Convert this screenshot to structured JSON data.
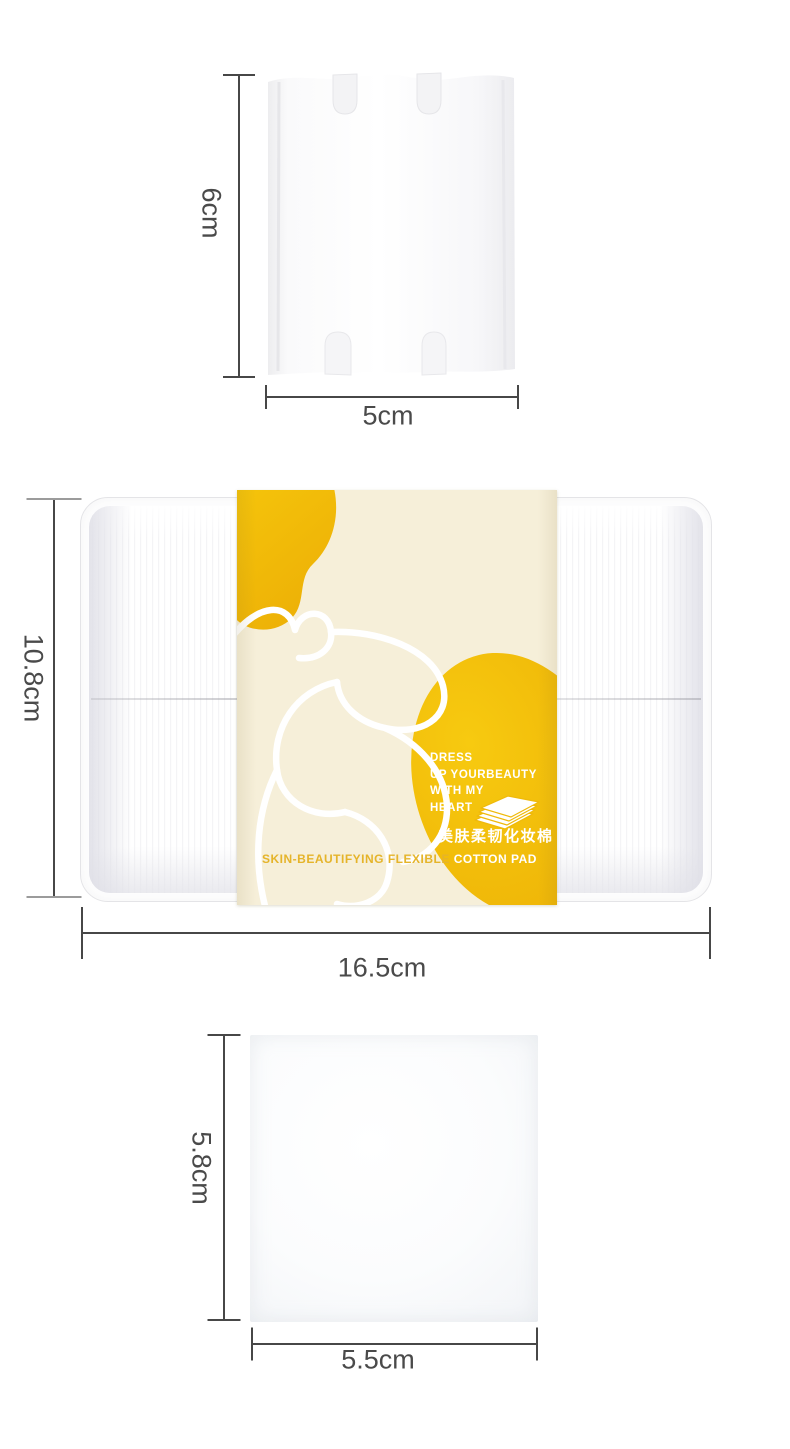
{
  "product_dimensions": {
    "pad_top": {
      "height": "6cm",
      "width": "5cm"
    },
    "package": {
      "height": "10.8cm",
      "width": "16.5cm"
    },
    "pad_bottom": {
      "height": "5.8cm",
      "width": "5.5cm"
    }
  },
  "package_label": {
    "slogan_lines": [
      "DRESS",
      "UP YOURBEAUTY",
      "WITH MY",
      "HEART"
    ],
    "product_name_cn": "美肤柔韧化妆棉",
    "product_name_en_first": "SKIN-BEAUTIFYING FLEXIBLE",
    "product_name_en_second": "COTTON PAD",
    "icon": "cotton-pad-stack-icon"
  },
  "colors": {
    "page_background": "#FFFFFF",
    "label_cream": "#F6EFD9",
    "accent_yellow": "#F5C20A",
    "accent_yellow_deep": "#ECAE04",
    "gold_text": "#E5B42A",
    "measure_line": "#474747",
    "measure_text": "#4A4A4A"
  }
}
